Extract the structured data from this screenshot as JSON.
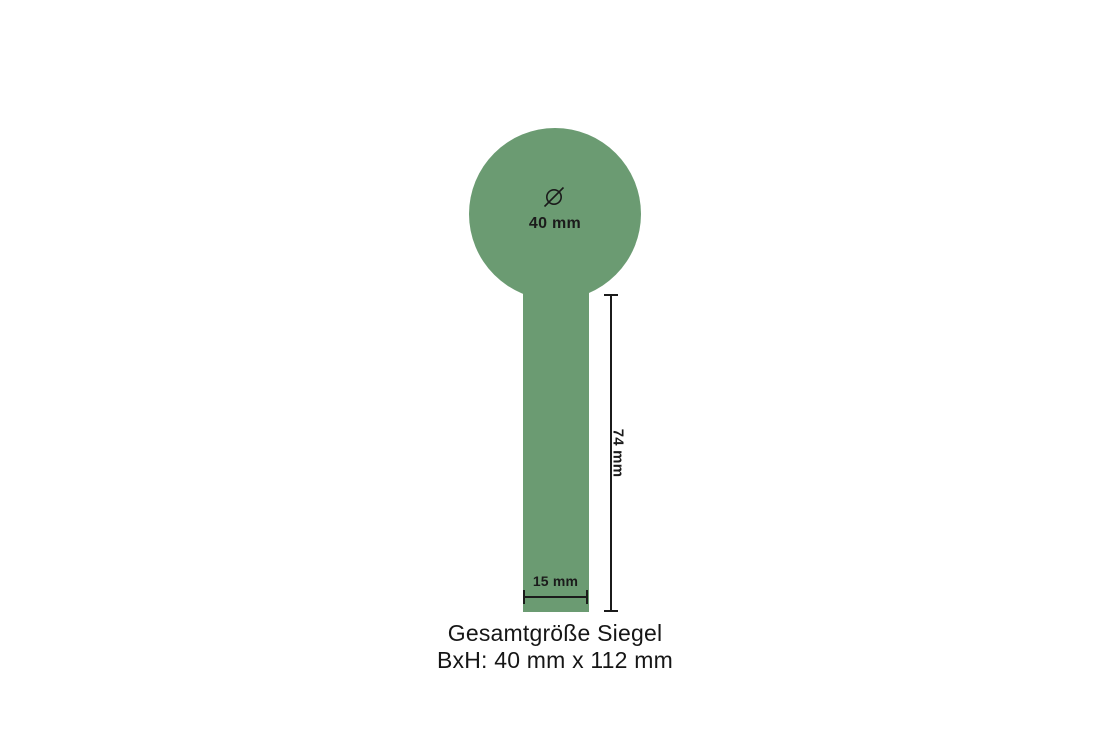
{
  "page": {
    "background": "#FFFFFF"
  },
  "diagram": {
    "seal_color": "#6B9B72",
    "line_color": "#1B1B1B",
    "diameter_symbol": "Ø",
    "diameter_label": "40 mm",
    "stem_width_label": "15 mm",
    "stem_height_label": "74 mm",
    "caption_line1": "Gesamtgröße Siegel",
    "caption_line2": "BxH: 40 mm x 112 mm"
  }
}
